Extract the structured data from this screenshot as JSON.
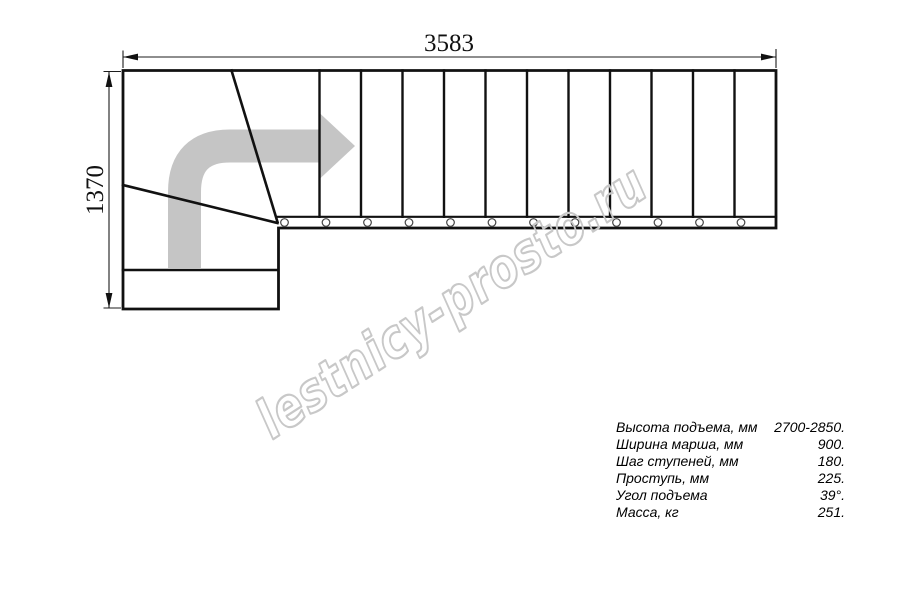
{
  "drawing": {
    "dimension_top_mm": "3583",
    "dimension_left_mm": "1370",
    "watermark_text": "lestnicy-prosto.ru",
    "straight_treads_count": 12,
    "winder_treads_count": 2,
    "bolt_circles_count": 12
  },
  "specs": {
    "rows": [
      {
        "label": "Высота подъема, мм",
        "value": "2700-2850."
      },
      {
        "label": "Ширина марша, мм",
        "value": "900."
      },
      {
        "label": "Шаг ступеней, мм",
        "value": "180."
      },
      {
        "label": "Проступь, мм",
        "value": "225."
      },
      {
        "label": "Угол подъема",
        "value": "39°."
      },
      {
        "label": "Масса, кг",
        "value": "251."
      }
    ]
  },
  "colors": {
    "line": "#111111",
    "dimension": "#1c1c1c",
    "arrow_fill": "#c5c5c5",
    "watermark_stroke": "#c8c8c8",
    "bolt_stroke": "#444444"
  }
}
